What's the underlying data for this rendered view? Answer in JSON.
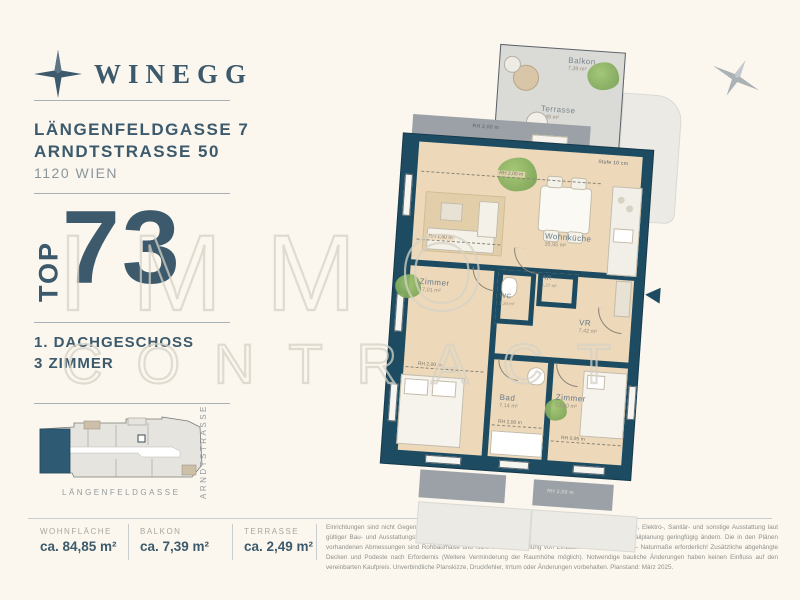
{
  "brand": {
    "name": "WINEGG"
  },
  "project": {
    "address_line1": "LÄNGENFELDGASSE 7",
    "address_line2": "ARNDTSTRASSE 50",
    "city": "1120 WIEN"
  },
  "unit": {
    "top_label": "TOP",
    "top_number": "73",
    "floor": "1. DACHGESCHOSS",
    "rooms": "3 ZIMMER"
  },
  "site_plan": {
    "street_bottom": "LÄNGENFELDGASSE",
    "street_right": "ARNDTSTRASSE"
  },
  "metrics": [
    {
      "label": "WOHNFLÄCHE",
      "value": "ca. 84,85 m²"
    },
    {
      "label": "BALKON",
      "value": "ca. 7,39 m²"
    },
    {
      "label": "TERRASSE",
      "value": "ca. 2,49 m²"
    }
  ],
  "disclaimer": "Einrichtungen sind nicht Gegenstand des Vertrages und dienen nur als Vorschlag. Boden- und Wandbeläge, Elektro-, Sanitär- und sonstige Ausstattung laut gültiger Bau- und Ausstattungsbeschreibung. Die Raum- und Wohnungsgrößen können sich durch die Detailplanung geringfügig ändern. Die in den Plänen vorhandenen Abmessungen sind Rohbaumaße und nicht für die Bestellung von Einbaumöbeln verwendbar – Naturmaße erforderlich! Zusätzliche abgehängte Decken und Podeste nach Erfordernis (Weitere Verminderung der Raumhöhe möglich). Notwendige bauliche Änderungen haben keinen Einfluss auf den vereinbarten Kaufpreis. Unverbindliche Planskizze, Druckfehler, Irrtum oder Änderungen vorbehalten. Planstand: März 2025.",
  "watermark": {
    "line1": "IMMO",
    "line2": "CONTRACT"
  },
  "floorplan": {
    "rooms": {
      "balkon": {
        "name": "Balkon",
        "area": "7,39 m²"
      },
      "terrasse": {
        "name": "Terrasse",
        "area": "2,49 m²"
      },
      "wohnkueche": {
        "name": "Wohnküche",
        "area": "35,95 m²"
      },
      "zimmer1": {
        "name": "Zimmer",
        "area": "17,01 m²"
      },
      "wc": {
        "name": "WC",
        "area": "1,34 m²"
      },
      "ar": {
        "name": "AR",
        "area": "1,27 m²"
      },
      "vr": {
        "name": "VR",
        "area": "7,42 m²"
      },
      "bad": {
        "name": "Bad",
        "area": "7,14 m²"
      },
      "zimmer2": {
        "name": "Zimmer",
        "area": "13,40 m²"
      }
    },
    "annotations": {
      "rh200": "RH 2,00 m",
      "rh150": "RH 1,50 m",
      "rh095": "RH 0,95 m",
      "stufe": "Stufe 10 cm"
    }
  },
  "colors": {
    "accent": "#3c5a6c",
    "wall": "#1d4c62",
    "floor": "#edd9ba",
    "unit_highlight": "#2e5a74",
    "background": "#fbf7ee"
  }
}
